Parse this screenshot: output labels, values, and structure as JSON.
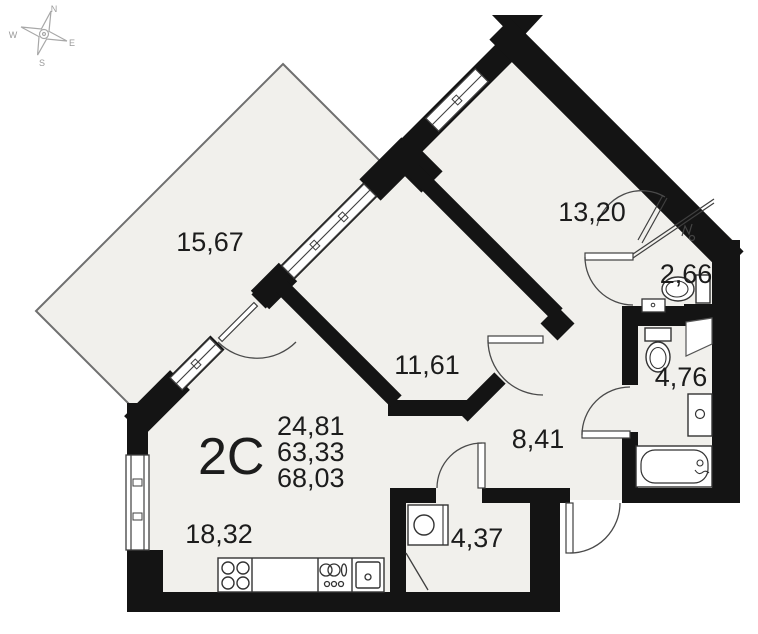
{
  "plan": {
    "unit_label": "2C",
    "areas": {
      "rooms_area": "24,81",
      "living_area": "63,33",
      "total_area": "68,03"
    },
    "rooms": [
      {
        "id": "loggia",
        "area": "15,67"
      },
      {
        "id": "room-13",
        "area": "13,20"
      },
      {
        "id": "wc",
        "area": "2,66"
      },
      {
        "id": "room-11",
        "area": "11,61"
      },
      {
        "id": "bathroom",
        "area": "4,76"
      },
      {
        "id": "hallway",
        "area": "8,41"
      },
      {
        "id": "storage",
        "area": "4,37"
      },
      {
        "id": "kitchen-living",
        "area": "18,32"
      }
    ],
    "compass": {
      "north": "N",
      "east": "E",
      "south": "S",
      "west": "W"
    },
    "icons": {
      "stove": "stove-burners-icon",
      "kitchen_sink": "kitchen-sink-icon",
      "dish_rack": "dish-rack-icon",
      "washing_machine": "washing-machine-icon",
      "toilet": "toilet-icon",
      "bathtub": "bathtub-icon",
      "wc_sink": "washbasin-icon",
      "towel_dryer": "towel-dryer-icon",
      "compass": "compass-rose-icon"
    },
    "colors": {
      "wall": "#141414",
      "room_fill": "#f1f0ec",
      "thin_line": "#3f3f3f"
    }
  }
}
